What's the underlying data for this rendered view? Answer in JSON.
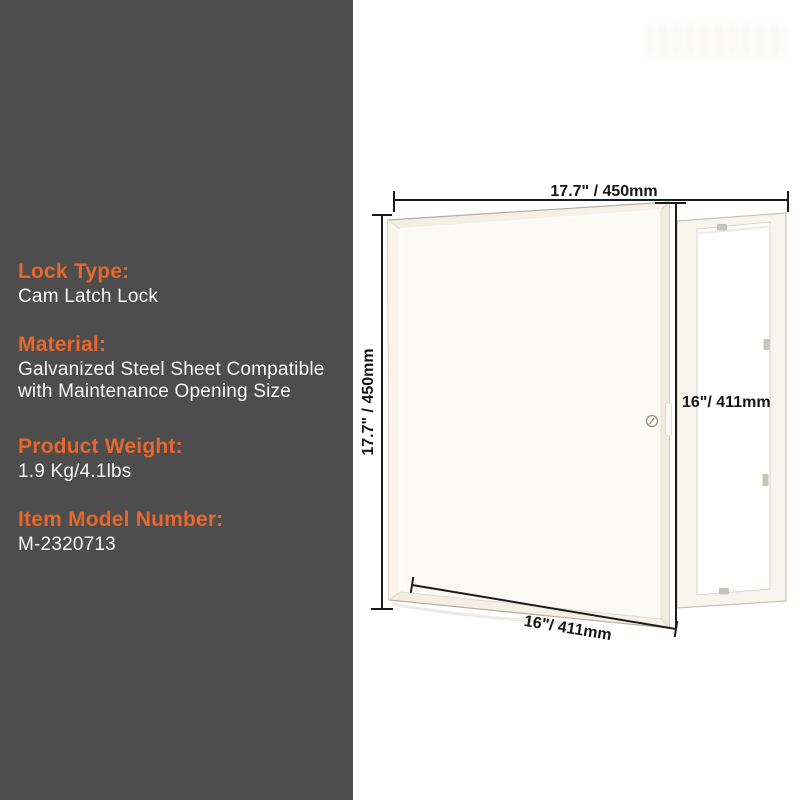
{
  "colors": {
    "panel_bg": "#4D4D4D",
    "accent_orange": "#E7672C",
    "body_text": "#F6F6F6",
    "dimension_line": "#1C1C1C",
    "door_fill": "#F5EFE6",
    "frame_fill": "#F8F5EF"
  },
  "specs": [
    {
      "label": "Lock Type:",
      "value": "Cam Latch Lock"
    },
    {
      "label": "Material:",
      "value": "Galvanized Steel Sheet Compatible with Maintenance Opening Size"
    },
    {
      "label": "Product Weight:",
      "value": "1.9 Kg/4.1lbs"
    },
    {
      "label": "Item Model Number:",
      "value": "M-2320713"
    }
  ],
  "diagram": {
    "dimensions": {
      "top": "17.7\" / 450mm",
      "left": "17.7\" / 450mm",
      "right": "16\"/ 411mm",
      "bottom": "16\"/ 411mm"
    }
  }
}
